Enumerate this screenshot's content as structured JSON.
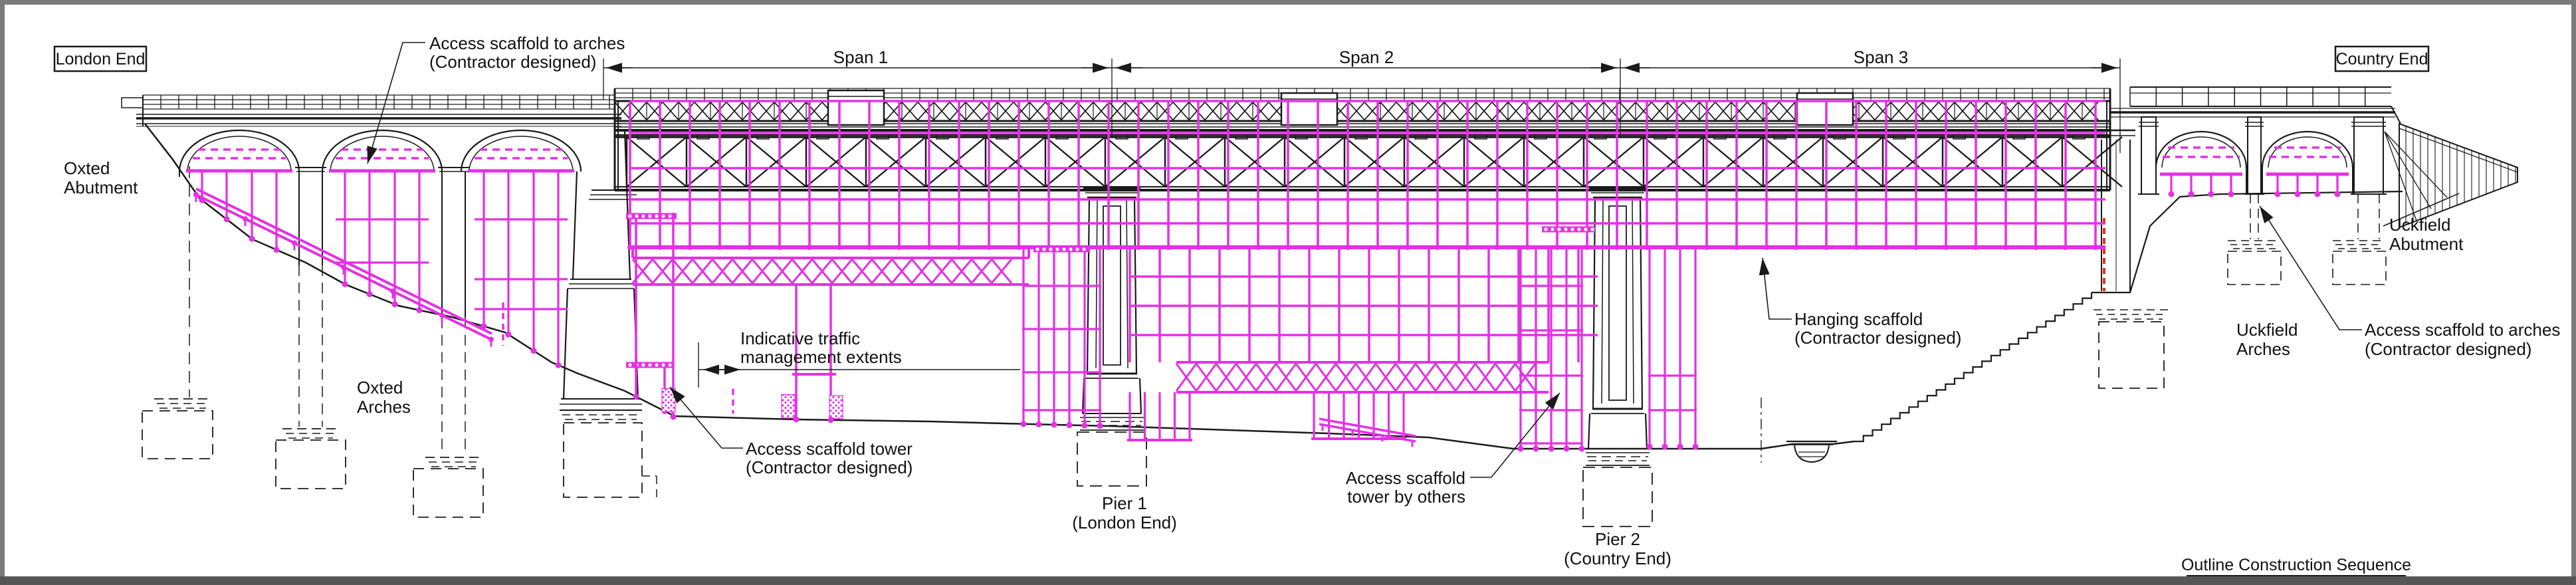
{
  "end_markers": {
    "left": "London End",
    "right": "Country End"
  },
  "spans": {
    "span1": "Span 1",
    "span2": "Span 2",
    "span3": "Span 3"
  },
  "labels": {
    "access_scaffold_arches_left": {
      "line1": "Access scaffold to arches",
      "line2": "(Contractor designed)"
    },
    "oxted_abutment": {
      "line1": "Oxted",
      "line2": "Abutment"
    },
    "oxted_arches": {
      "line1": "Oxted",
      "line2": "Arches"
    },
    "traffic_management": {
      "line1": "Indicative traffic",
      "line2": "management extents"
    },
    "access_scaffold_tower": {
      "line1": "Access scaffold tower",
      "line2": "(Contractor designed)"
    },
    "pier_1": {
      "line1": "Pier 1",
      "line2": "(London End)"
    },
    "access_scaffold_tower_others": {
      "line1": "Access scaffold",
      "line2": "tower by others"
    },
    "pier_2": {
      "line1": "Pier 2",
      "line2": "(Country End)"
    },
    "hanging_scaffold": {
      "line1": "Hanging scaffold",
      "line2": "(Contractor designed)"
    },
    "uckfield_abutment": {
      "line1": "Uckfield",
      "line2": "Abutment"
    },
    "uckfield_arches": {
      "line1": "Uckfield",
      "line2": "Arches"
    },
    "access_scaffold_arches_right": {
      "line1": "Access scaffold to arches",
      "line2": "(Contractor designed)"
    },
    "drawing_title": "Outline Construction Sequence"
  },
  "colors": {
    "scaffold": "#e431e4",
    "drawing_line": "#1a1a1a",
    "highlight_red": "#e0301e",
    "sheet": "#ffffff",
    "frame_light": "#7b7b7b",
    "frame_dark": "#565656"
  }
}
